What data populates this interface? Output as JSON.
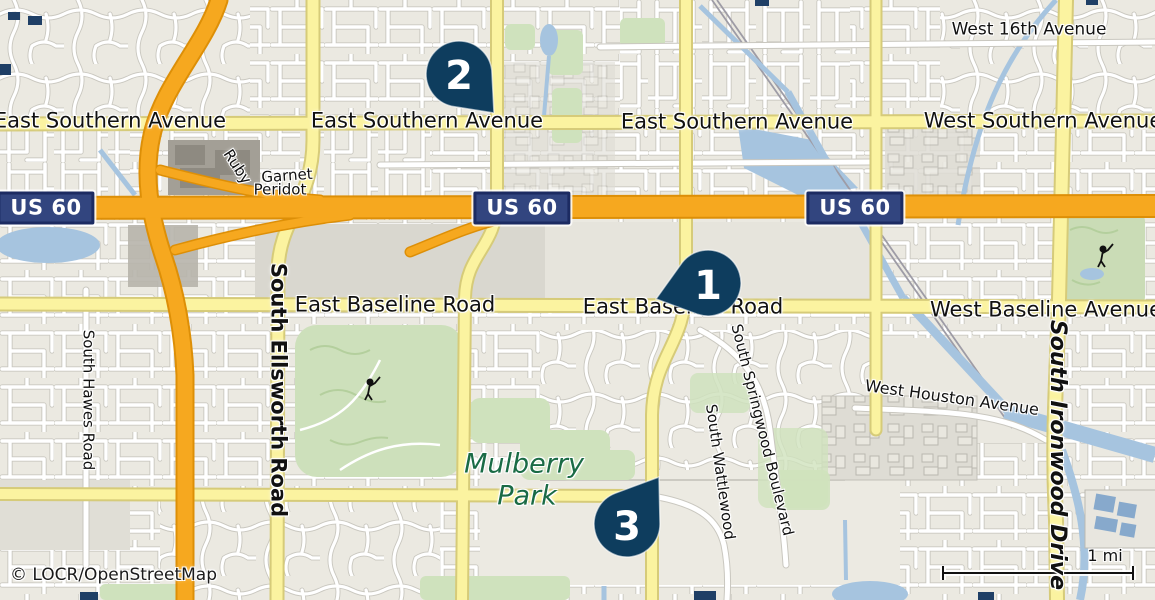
{
  "map": {
    "attribution": "© LOCR/OpenStreetMap",
    "scale": {
      "label": "1 mi"
    },
    "park": {
      "name_line1": "Mulberry",
      "name_line2": "Park"
    },
    "highway_shields": [
      {
        "text": "US 60"
      },
      {
        "text": "US 60"
      },
      {
        "text": "US 60"
      }
    ],
    "markers": [
      {
        "number": "1"
      },
      {
        "number": "2"
      },
      {
        "number": "3"
      }
    ],
    "street_labels": {
      "east_southern_1": "East Southern Avenue",
      "east_southern_2": "East Southern Avenue",
      "east_southern_3": "East Southern Avenue",
      "west_southern": "West Southern Avenue",
      "west_16th": "West 16th Avenue",
      "east_baseline_1": "East Baseline Road",
      "east_baseline_2": "East Baseline Road",
      "west_baseline": "West Baseline Avenue",
      "south_ellsworth": "South Ellsworth Road",
      "south_hawes": "South Hawes Road",
      "south_ironwood": "South Ironwood Drive",
      "west_houston": "West Houston Avenue",
      "south_springwood": "South Springwood Boulevard",
      "south_wattlewood": "South Wattlewood",
      "ruby": "Ruby",
      "garnet": "Garnet",
      "peridot": "Peridot"
    },
    "colors": {
      "background": "#f0eee6",
      "marker": "#0e3d5e",
      "shield_fill": "#32457f",
      "shield_border": "#1c2b62",
      "freeway": "#f6a81f",
      "arterial_yellow": "#fbf3a0",
      "water": "#a6c4df",
      "park_green": "#cde0bb",
      "park_label": "#1a6b45"
    }
  }
}
